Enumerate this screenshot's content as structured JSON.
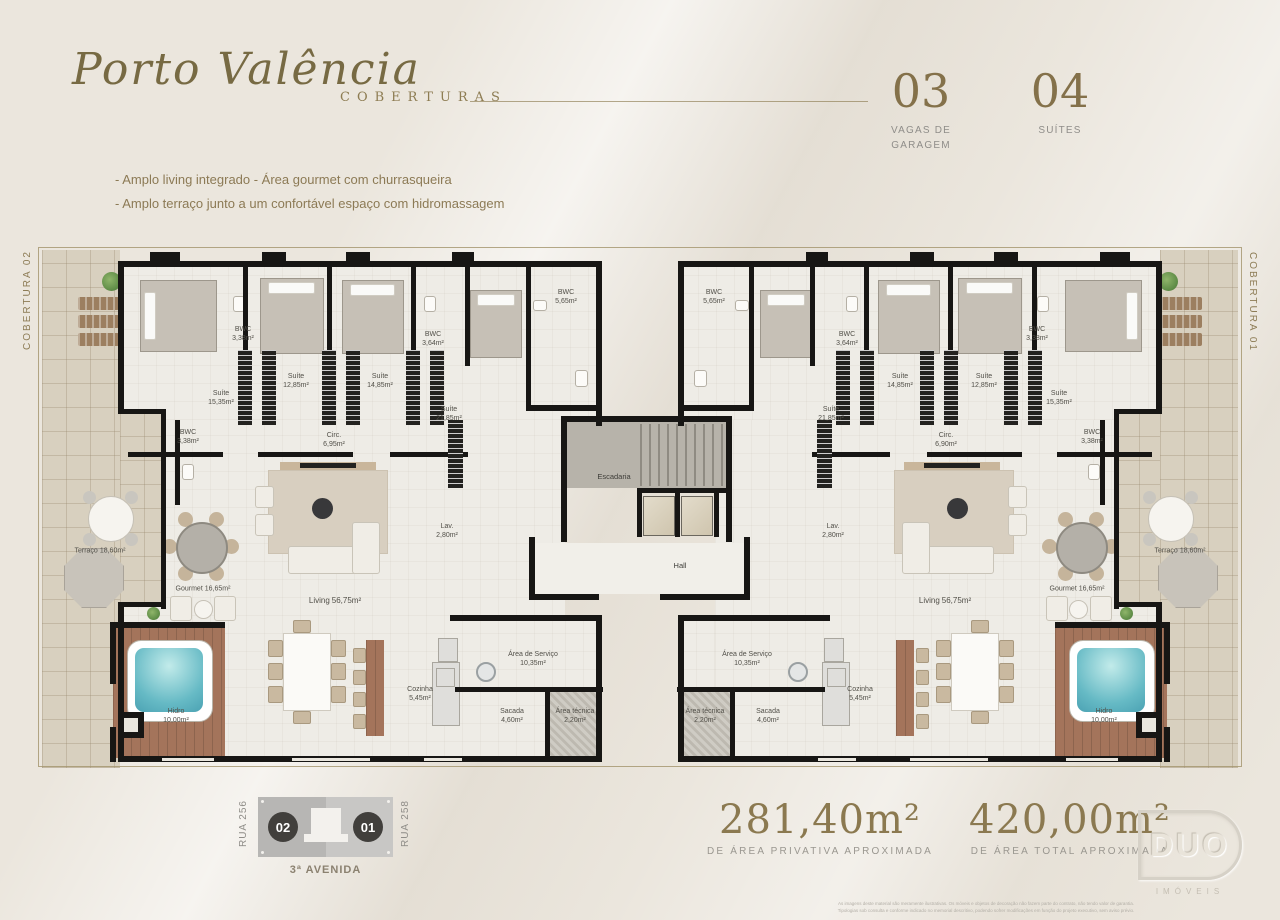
{
  "header": {
    "brand": "Porto Valência",
    "collection": "COBERTURAS",
    "features": [
      "- Amplo living integrado - Área gourmet com churrasqueira",
      "- Amplo terraço junto a um confortável espaço com hidromassagem"
    ],
    "stats": [
      {
        "value": "03",
        "label": "VAGAS DE\nGARAGEM"
      },
      {
        "value": "04",
        "label": "SUÍTES"
      }
    ]
  },
  "plan": {
    "tag_left": "COBERTURA 02",
    "tag_right": "COBERTURA 01",
    "core": {
      "stairs": "Escadaria",
      "hall": "Hall"
    },
    "u2": {
      "rooms": [
        {
          "n": "Suíte",
          "a": "15,35m²"
        },
        {
          "n": "BWC",
          "a": "3,38m²"
        },
        {
          "n": "Suíte",
          "a": "12,85m²"
        },
        {
          "n": "Suíte",
          "a": "14,85m²"
        },
        {
          "n": "BWC",
          "a": "3,64m²"
        },
        {
          "n": "Suíte",
          "a": "21,85m²"
        },
        {
          "n": "BWC",
          "a": "3,38m²"
        },
        {
          "n": "Circ.",
          "a": "6,95m²"
        },
        {
          "n": "BWC",
          "a": "5,65m²"
        },
        {
          "n": "Terraço",
          "a": "18,60m²"
        },
        {
          "n": "Gourmet",
          "a": "16,65m²"
        },
        {
          "n": "Living",
          "a": "56,75m²"
        },
        {
          "n": "Lav.",
          "a": "2,80m²"
        },
        {
          "n": "Hidro",
          "a": "10,00m²"
        },
        {
          "n": "Cozinha",
          "a": "5,45m²"
        },
        {
          "n": "Área de Serviço",
          "a": "10,35m²"
        },
        {
          "n": "Sacada",
          "a": "4,60m²"
        },
        {
          "n": "Área técnica",
          "a": "2,20m²"
        }
      ]
    },
    "u1": {
      "rooms": [
        {
          "n": "Suíte",
          "a": "15,35m²"
        },
        {
          "n": "BWC",
          "a": "3,38m²"
        },
        {
          "n": "Suíte",
          "a": "12,85m²"
        },
        {
          "n": "Suíte",
          "a": "14,85m²"
        },
        {
          "n": "BWC",
          "a": "3,64m²"
        },
        {
          "n": "Suíte",
          "a": "21,85m²"
        },
        {
          "n": "BWC",
          "a": "3,38m²"
        },
        {
          "n": "Circ.",
          "a": "6,90m²"
        },
        {
          "n": "BWC",
          "a": "5,65m²"
        },
        {
          "n": "Terraço",
          "a": "18,60m²"
        },
        {
          "n": "Gourmet",
          "a": "16,65m²"
        },
        {
          "n": "Living",
          "a": "56,75m²"
        },
        {
          "n": "Lav.",
          "a": "2,80m²"
        },
        {
          "n": "Hidro",
          "a": "10,00m²"
        },
        {
          "n": "Cozinha",
          "a": "5,45m²"
        },
        {
          "n": "Área de Serviço",
          "a": "10,35m²"
        },
        {
          "n": "Sacada",
          "a": "4,60m²"
        },
        {
          "n": "Área técnica",
          "a": "2,20m²"
        }
      ]
    }
  },
  "footer": {
    "keyplan": {
      "street_left": "RUA 256",
      "street_right": "RUA 258",
      "avenue": "3ª AVENIDA",
      "unit_left": "02",
      "unit_right": "01"
    },
    "areas": [
      {
        "value": "281,40m²",
        "label": "DE ÁREA PRIVATIVA APROXIMADA"
      },
      {
        "value": "420,00m²",
        "label": "DE ÁREA TOTAL APROXIMADA"
      }
    ],
    "disclaimer": "As imagens deste material são meramente ilustrativas. Os móveis e objetos de decoração não fazem parte do contrato, não tendo valor de garantia.\nTipologias sob consulta e conforme indicado no memorial descritivo, podendo sofrer modificações em função do projeto executivo, sem aviso prévio.",
    "logo": {
      "name": "DUO",
      "sub": "IMÓVEIS"
    }
  }
}
